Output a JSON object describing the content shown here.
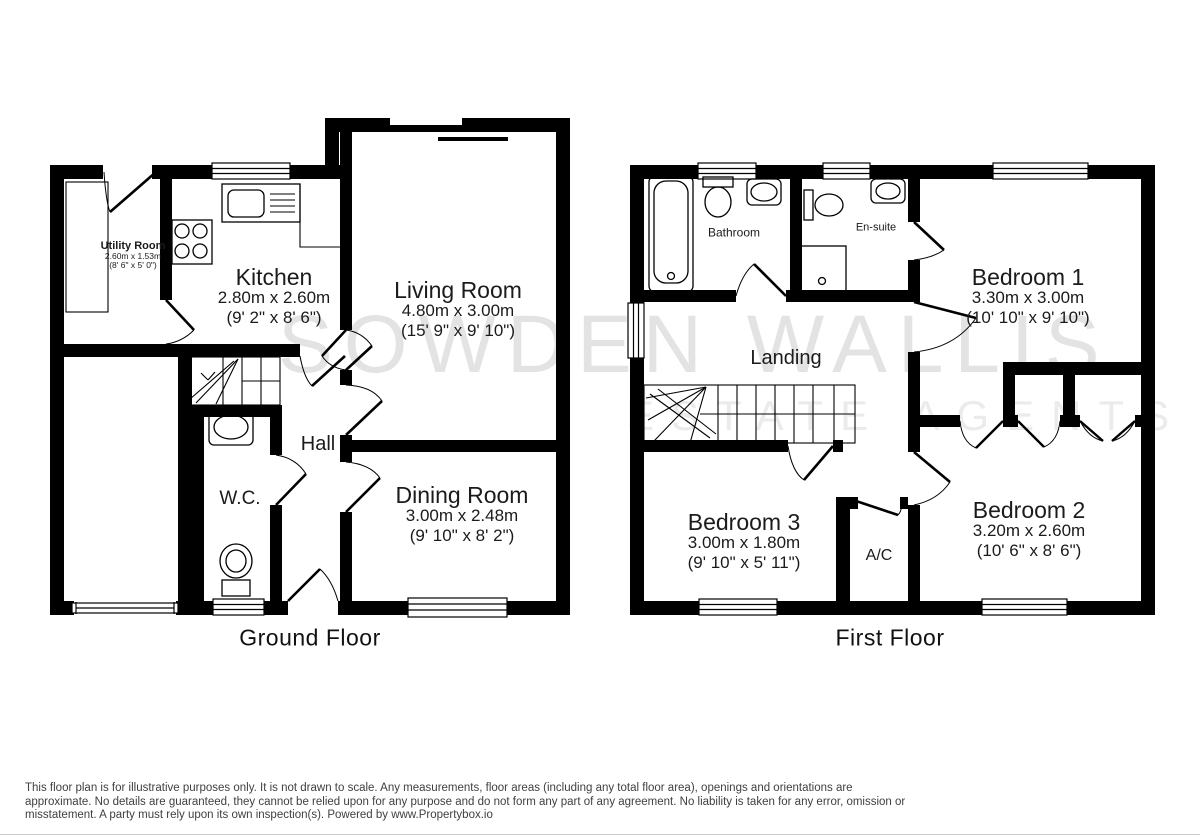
{
  "watermark": {
    "line1": "SOWDEN WALLIS",
    "line2": "ESTATE AGENTS"
  },
  "floors": [
    {
      "id": "ground",
      "label": "Ground Floor",
      "rooms": [
        {
          "id": "utility",
          "name": "Utility Room",
          "dims_m": "2.60m x 1.53m",
          "dims_ft": "(8' 6\" x 5' 0\")"
        },
        {
          "id": "kitchen",
          "name": "Kitchen",
          "dims_m": "2.80m x 2.60m",
          "dims_ft": "(9' 2\" x 8' 6\")"
        },
        {
          "id": "living",
          "name": "Living Room",
          "dims_m": "4.80m x 3.00m",
          "dims_ft": "(15' 9\" x 9' 10\")"
        },
        {
          "id": "hall",
          "name": "Hall"
        },
        {
          "id": "wc",
          "name": "W.C."
        },
        {
          "id": "dining",
          "name": "Dining Room",
          "dims_m": "3.00m x 2.48m",
          "dims_ft": "(9' 10\" x 8' 2\")"
        }
      ]
    },
    {
      "id": "first",
      "label": "First Floor",
      "rooms": [
        {
          "id": "bathroom",
          "name": "Bathroom"
        },
        {
          "id": "ensuite",
          "name": "En-suite"
        },
        {
          "id": "bedroom1",
          "name": "Bedroom 1",
          "dims_m": "3.30m x 3.00m",
          "dims_ft": "(10' 10\" x 9' 10\")"
        },
        {
          "id": "landing",
          "name": "Landing"
        },
        {
          "id": "bedroom3",
          "name": "Bedroom 3",
          "dims_m": "3.00m x 1.80m",
          "dims_ft": "(9' 10\" x 5' 11\")"
        },
        {
          "id": "ac",
          "name": "A/C"
        },
        {
          "id": "bedroom2",
          "name": "Bedroom 2",
          "dims_m": "3.20m x 2.60m",
          "dims_ft": "(10' 6\" x 8' 6\")"
        }
      ]
    }
  ],
  "disclaimer": {
    "lines": [
      "This floor plan is for illustrative purposes only. It is not drawn to scale. Any measurements, floor areas (including any total floor area), openings and orientations are",
      "approximate. No details are guaranteed, they cannot be relied upon for any purpose and do not form any part of any agreement. No liability is taken for any error, omission or",
      "misstatement. A party must rely upon its own inspection(s). Powered by www.Propertybox.io"
    ]
  },
  "colors": {
    "wall": "#000000",
    "watermark_large": "#e3e3e3",
    "watermark_small": "#ebebeb",
    "label_text": "#1b1b1b",
    "disclaimer_text": "#404040",
    "bottom_rule": "#cccccc"
  }
}
